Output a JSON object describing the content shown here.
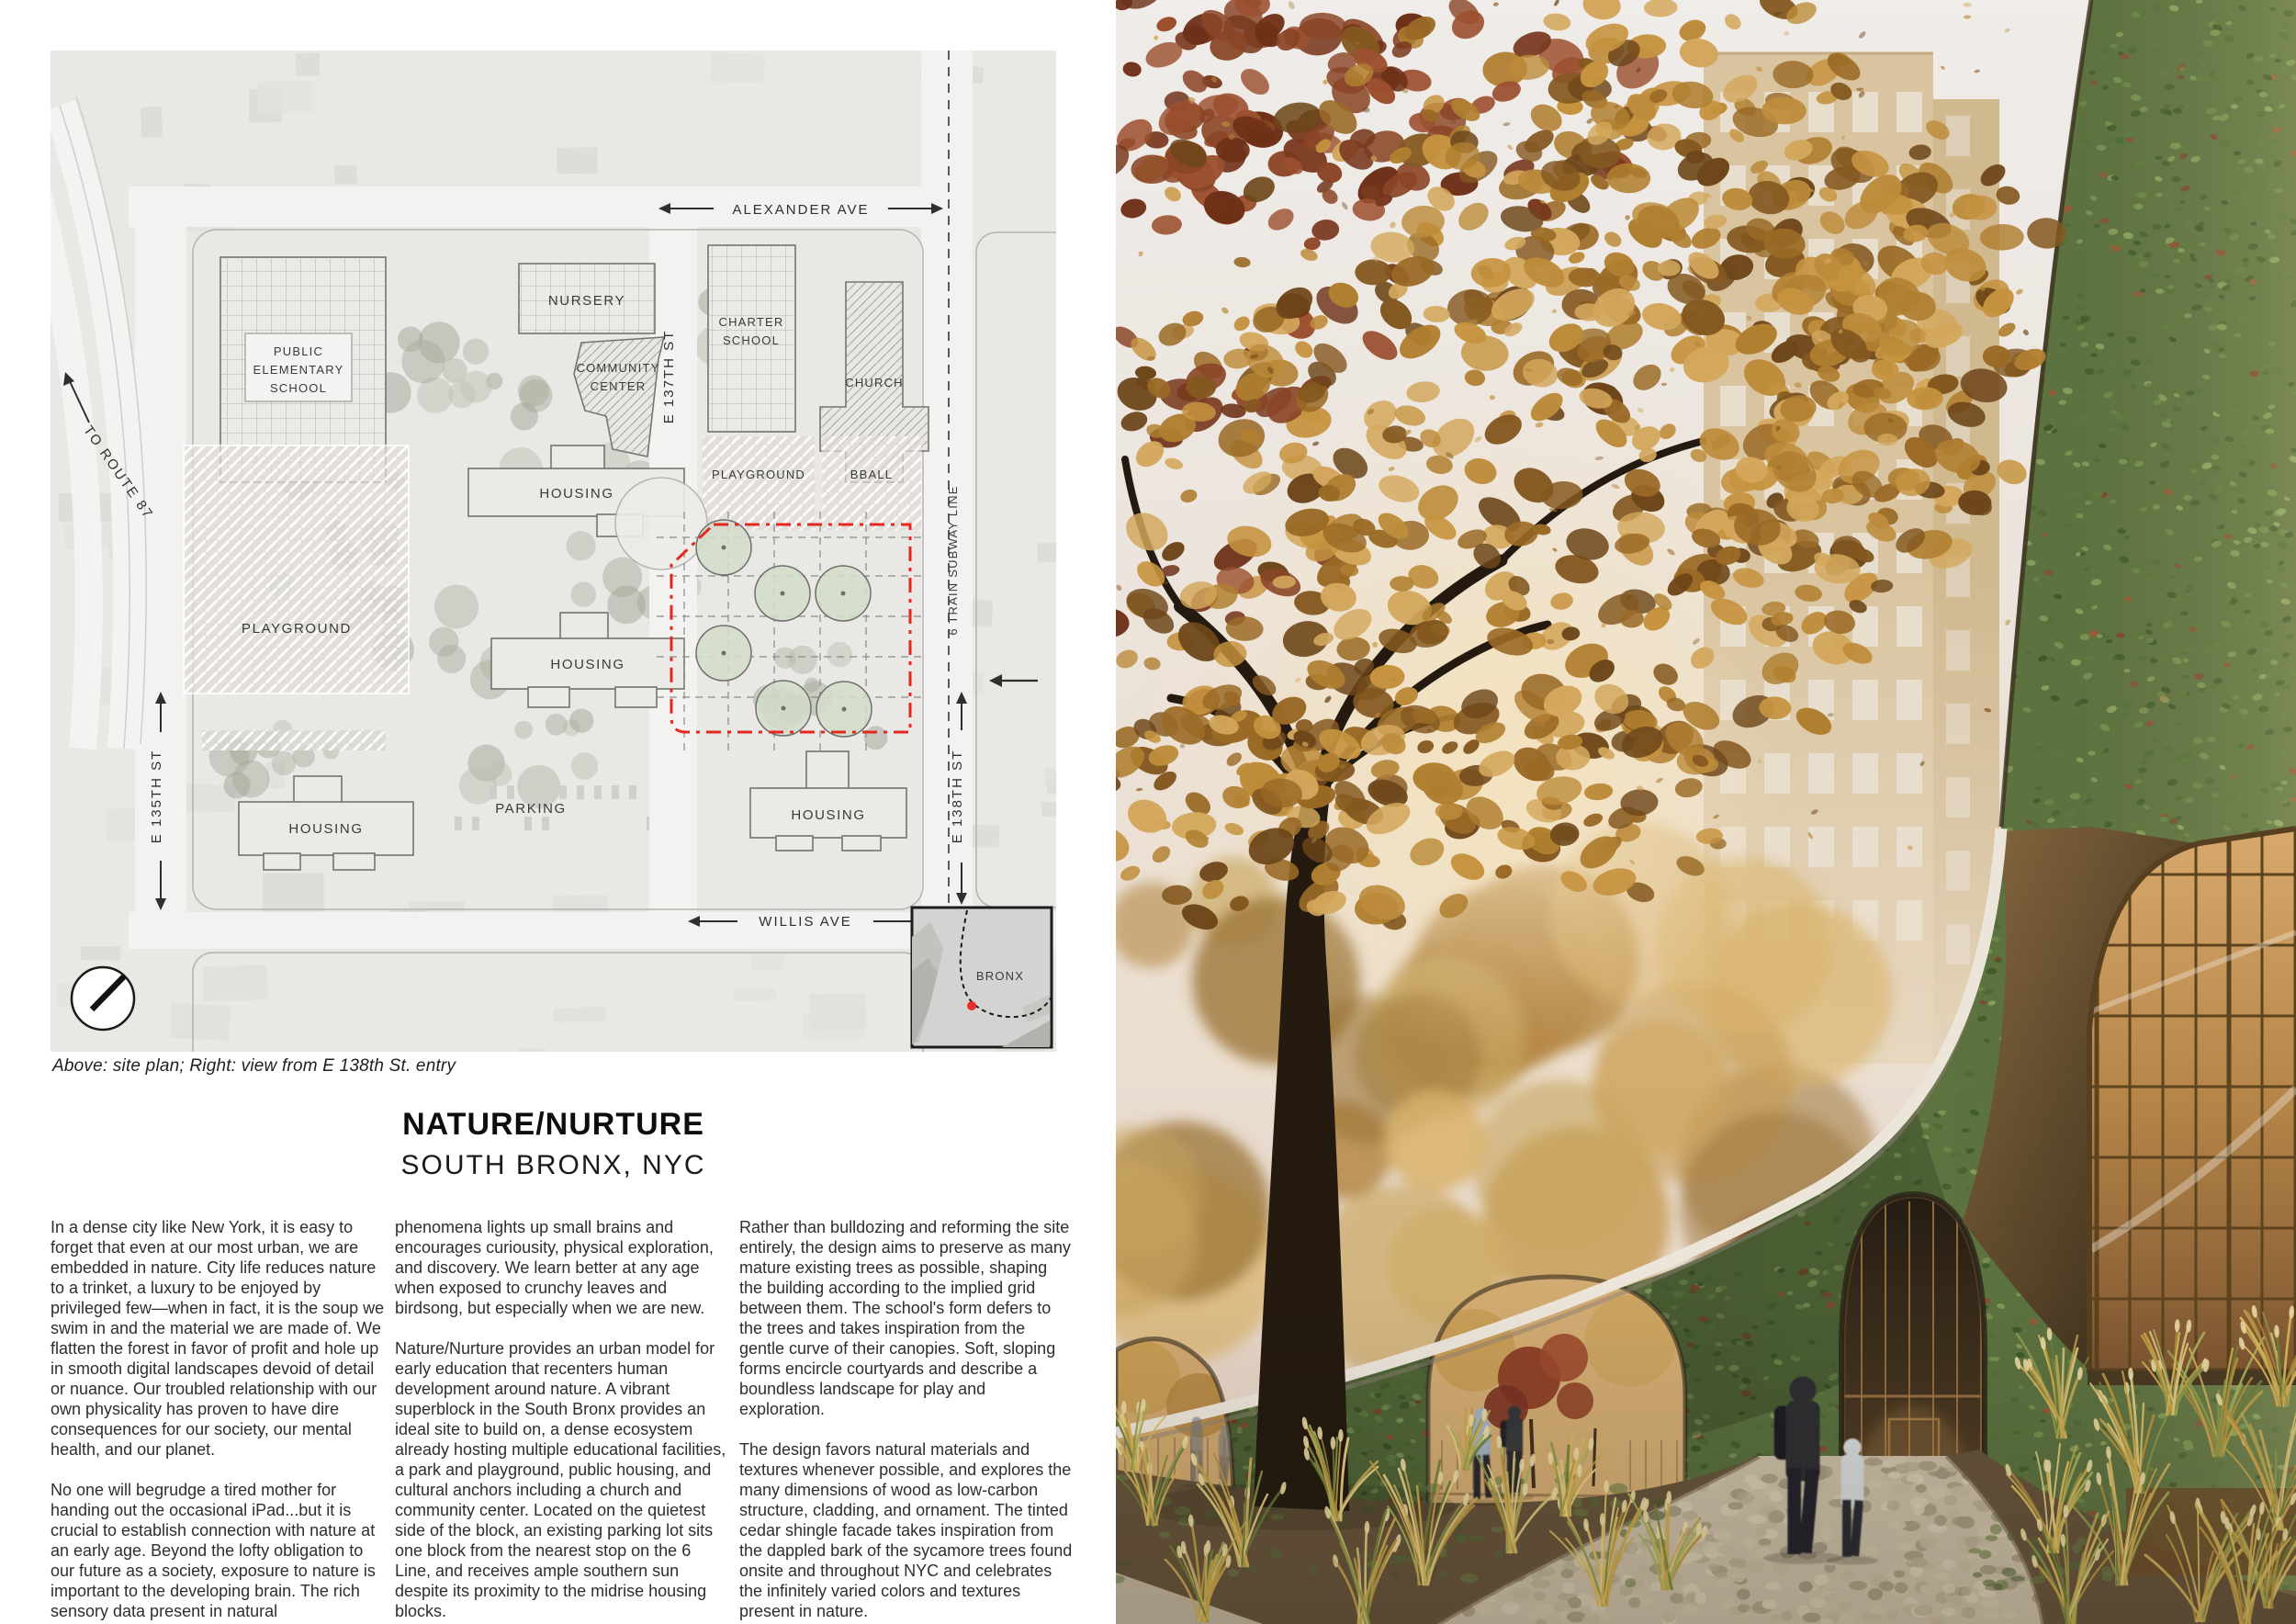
{
  "caption": "Above: site plan; Right: view from E 138th St. entry",
  "header": {
    "title": "NATURE/NURTURE",
    "subtitle": "SOUTH BRONX, NYC"
  },
  "columns": {
    "col1": {
      "p1": "In a dense city like New York, it is easy to forget that even at our most urban, we are embedded in nature. City life reduces nature to a trinket, a luxury to be enjoyed by privileged few—when in fact, it is the soup we swim in and the material we are made of. We flatten the forest in favor of profit and hole up in smooth digital landscapes devoid of detail or nuance. Our troubled relationship with our own physicality has proven to have dire consequences for our society, our mental health, and our planet.",
      "p2": "No one will begrudge a tired mother for handing out the occasional iPad...but it is crucial to establish connection with nature at an early age. Beyond the lofty obligation to our future as a society, exposure to nature is important to the developing brain. The rich sensory data present in natural"
    },
    "col2": {
      "p1": "phenomena lights up small brains and encourages curiousity, physical exploration, and discovery. We learn better at any age when exposed to crunchy leaves and birdsong, but especially when we are new.",
      "p2": "Nature/Nurture provides an urban model for early education that recenters human development around nature. A vibrant superblock in the South Bronx provides an ideal site to build on, a dense ecosystem already hosting multiple educational facilities, a park and playground, public housing, and cultural anchors including a church and community center. Located on the quietest side of the block, an existing parking lot sits one block from the nearest stop on the 6 Line, and receives ample southern sun despite its proximity to the midrise housing blocks."
    },
    "col3": {
      "p1": "Rather than bulldozing and reforming the site entirely, the design aims to preserve as many mature existing trees as possible, shaping the building according to the implied grid between them. The school's form defers to the trees and takes inspiration from the gentle curve of their canopies. Soft, sloping forms encircle courtyards and describe a boundless landscape for play and exploration.",
      "p2": "The design favors natural materials and textures whenever possible, and explores the many dimensions of wood as low-carbon structure, cladding, and ornament. The tinted cedar shingle facade takes inspiration from the dappled bark of the sycamore trees found onsite and throughout NYC and celebrates the infinitely varied colors and textures present in nature."
    }
  },
  "site_plan": {
    "labels": {
      "alexander_ave": "ALEXANDER AVE",
      "willis_ave": "WILLIS AVE",
      "e135": "E 135TH ST",
      "e137": "E 137TH ST",
      "e138": "E 138TH ST",
      "subway": "6 TRAIN SUBWAY LINE",
      "route87": "TO ROUTE 87",
      "public_school_l1": "PUBLIC",
      "public_school_l2": "ELEMENTARY",
      "public_school_l3": "SCHOOL",
      "nursery": "NURSERY",
      "community_l1": "COMMUNITY",
      "community_l2": "CENTER",
      "charter_l1": "CHARTER",
      "charter_l2": "SCHOOL",
      "church": "CHURCH",
      "housing_top": "HOUSING",
      "housing_mid": "HOUSING",
      "housing_bottom_left": "HOUSING",
      "housing_bottom_right": "HOUSING",
      "playground_left": "PLAYGROUND",
      "playground_top": "PLAYGROUND",
      "bball": "BBALL",
      "parking": "PARKING",
      "bronx": "BRONX"
    },
    "colors": {
      "site_boundary_red": "#e4271f",
      "tree_circle_fill": "#d3dcc9",
      "inset_dot_red": "#e8302a"
    }
  },
  "rendering": {
    "colors": {
      "sky_haze": "#eae0d6",
      "tower_tan": "#d9c29c",
      "shingle_green": "#5d7440",
      "autumn_amber": "#b07f30",
      "glazing_warm": "#c99a5e",
      "fascia_white": "#ece5da"
    }
  }
}
